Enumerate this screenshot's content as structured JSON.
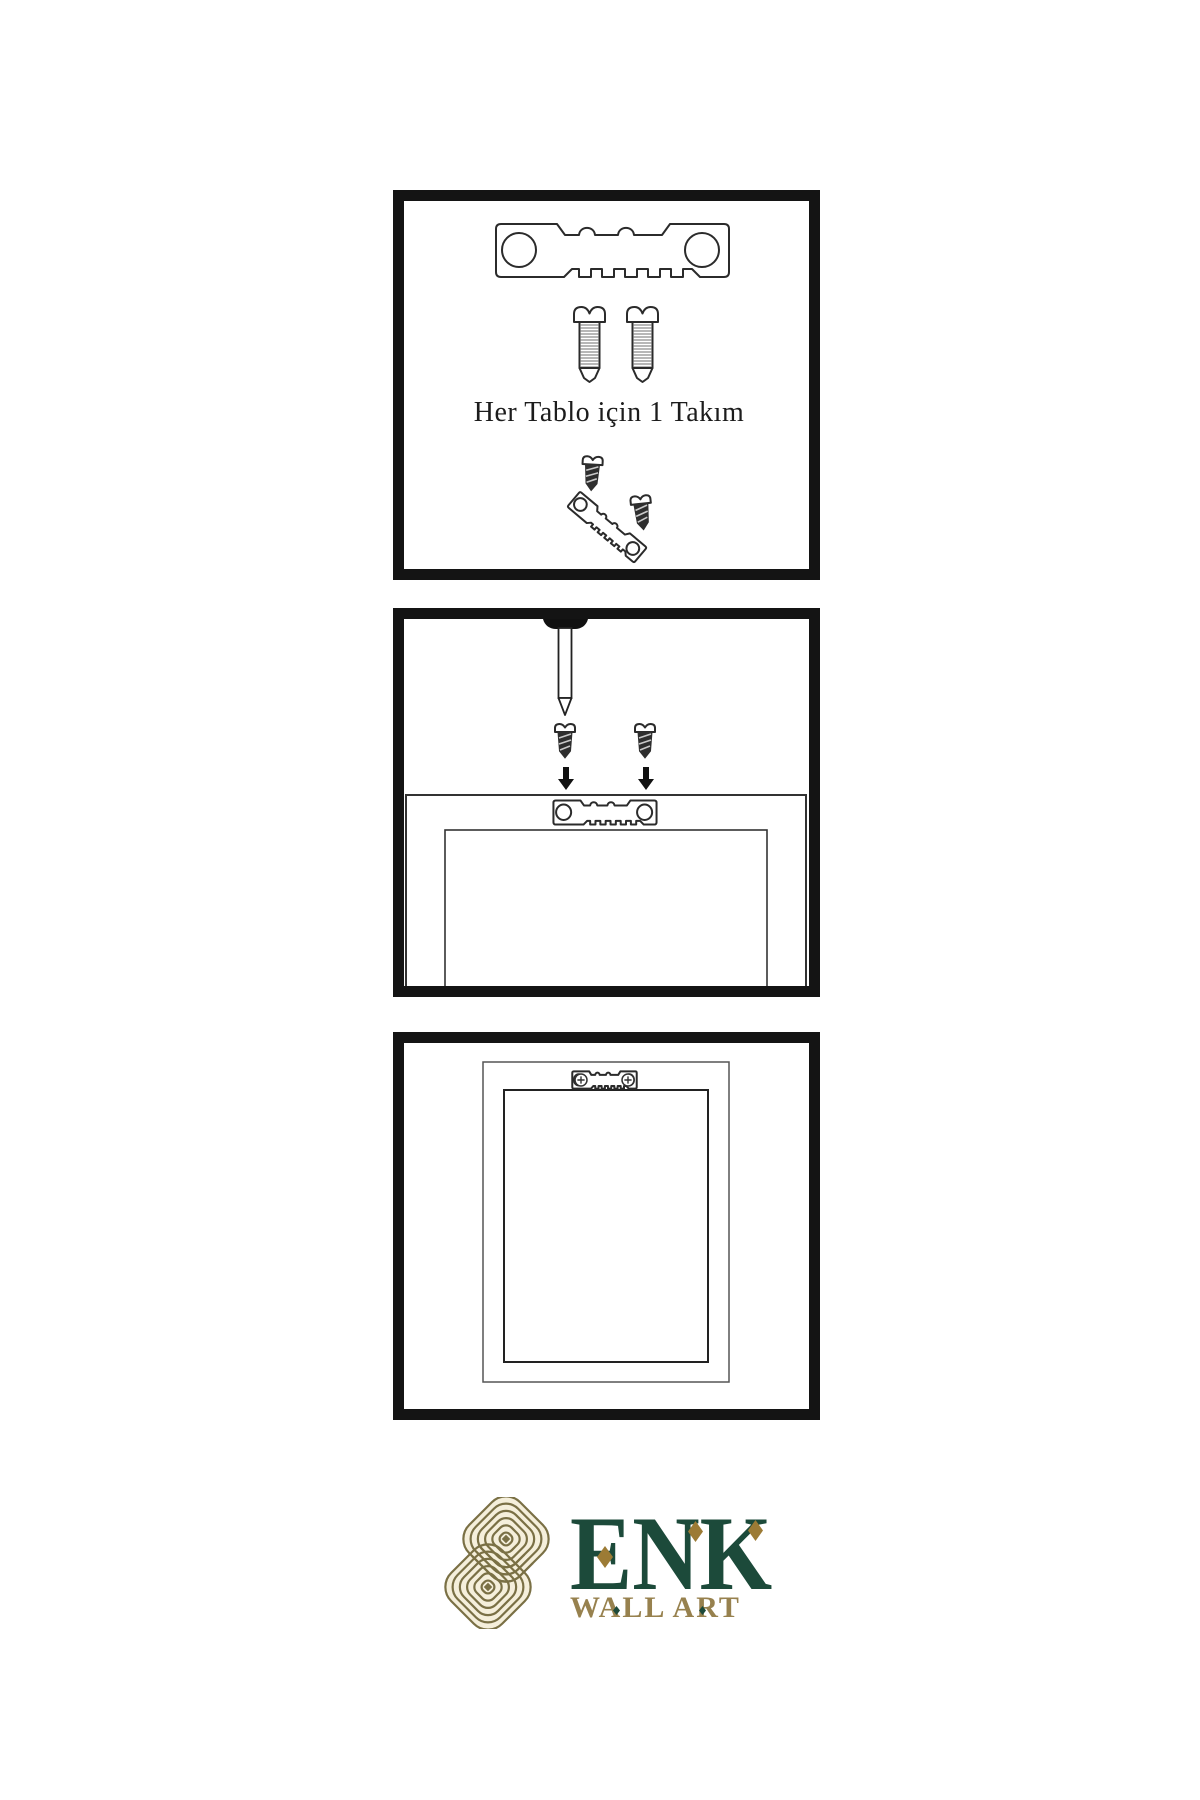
{
  "page": {
    "background": "#ffffff"
  },
  "colors": {
    "line_ink": "#2b2b2b",
    "panel_border": "#141414",
    "brand_green": "#1C4A3A",
    "brand_gold": "#9C7B35",
    "knot_olive": "#7a7045",
    "knot_cream": "#f5efdb",
    "tagline_gold": "#97814E"
  },
  "panels": [
    {
      "id": "hardware-kit",
      "caption": "Her Tablo için 1 Takım",
      "items": [
        "sawtooth-hanger",
        "mounting-screw",
        "mounting-screw",
        "small-screw",
        "tilted-sawtooth-hanger",
        "small-screw"
      ]
    },
    {
      "id": "mounting-steps",
      "items": [
        "wall-nail",
        "screw-with-down-arrow",
        "screw-with-down-arrow",
        "frame-back",
        "sawtooth-hanger"
      ]
    },
    {
      "id": "hung-frame",
      "items": [
        "picture-frame",
        "installed-sawtooth-hanger",
        "phillips-screw",
        "phillips-screw"
      ]
    }
  ],
  "logo": {
    "brand": "ENK",
    "tagline": "WALL ART"
  }
}
